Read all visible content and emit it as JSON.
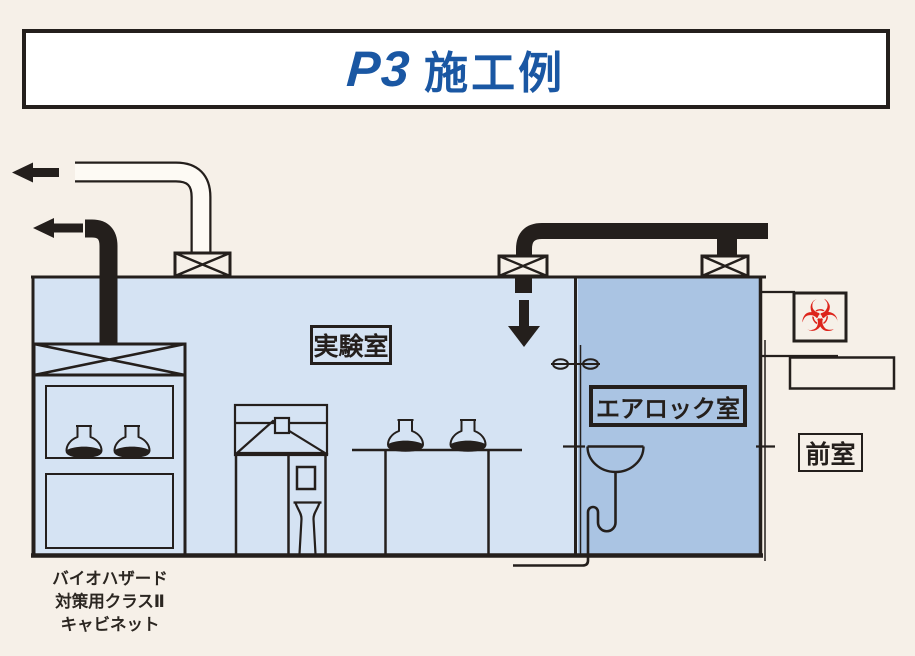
{
  "title": {
    "p3": "P3",
    "rest": "施工例"
  },
  "rooms": {
    "lab_label": "実験室",
    "airlock_label": "エアロック室",
    "anteroom_label": "前室"
  },
  "cabinet_caption": {
    "line1": "バイオハザード",
    "line2": "対策用クラスⅡ",
    "line3": "キャビネット"
  },
  "icons": {
    "biohazard_symbol": "☣"
  },
  "colors": {
    "background": "#f6f0e8",
    "lab_room_fill": "#d5e3f3",
    "airlock_fill": "#aac4e3",
    "line_ink": "#241f1c",
    "title_blue": "#1a57a3",
    "biohazard_red": "#dd241b",
    "title_box_bg": "#ffffff"
  }
}
